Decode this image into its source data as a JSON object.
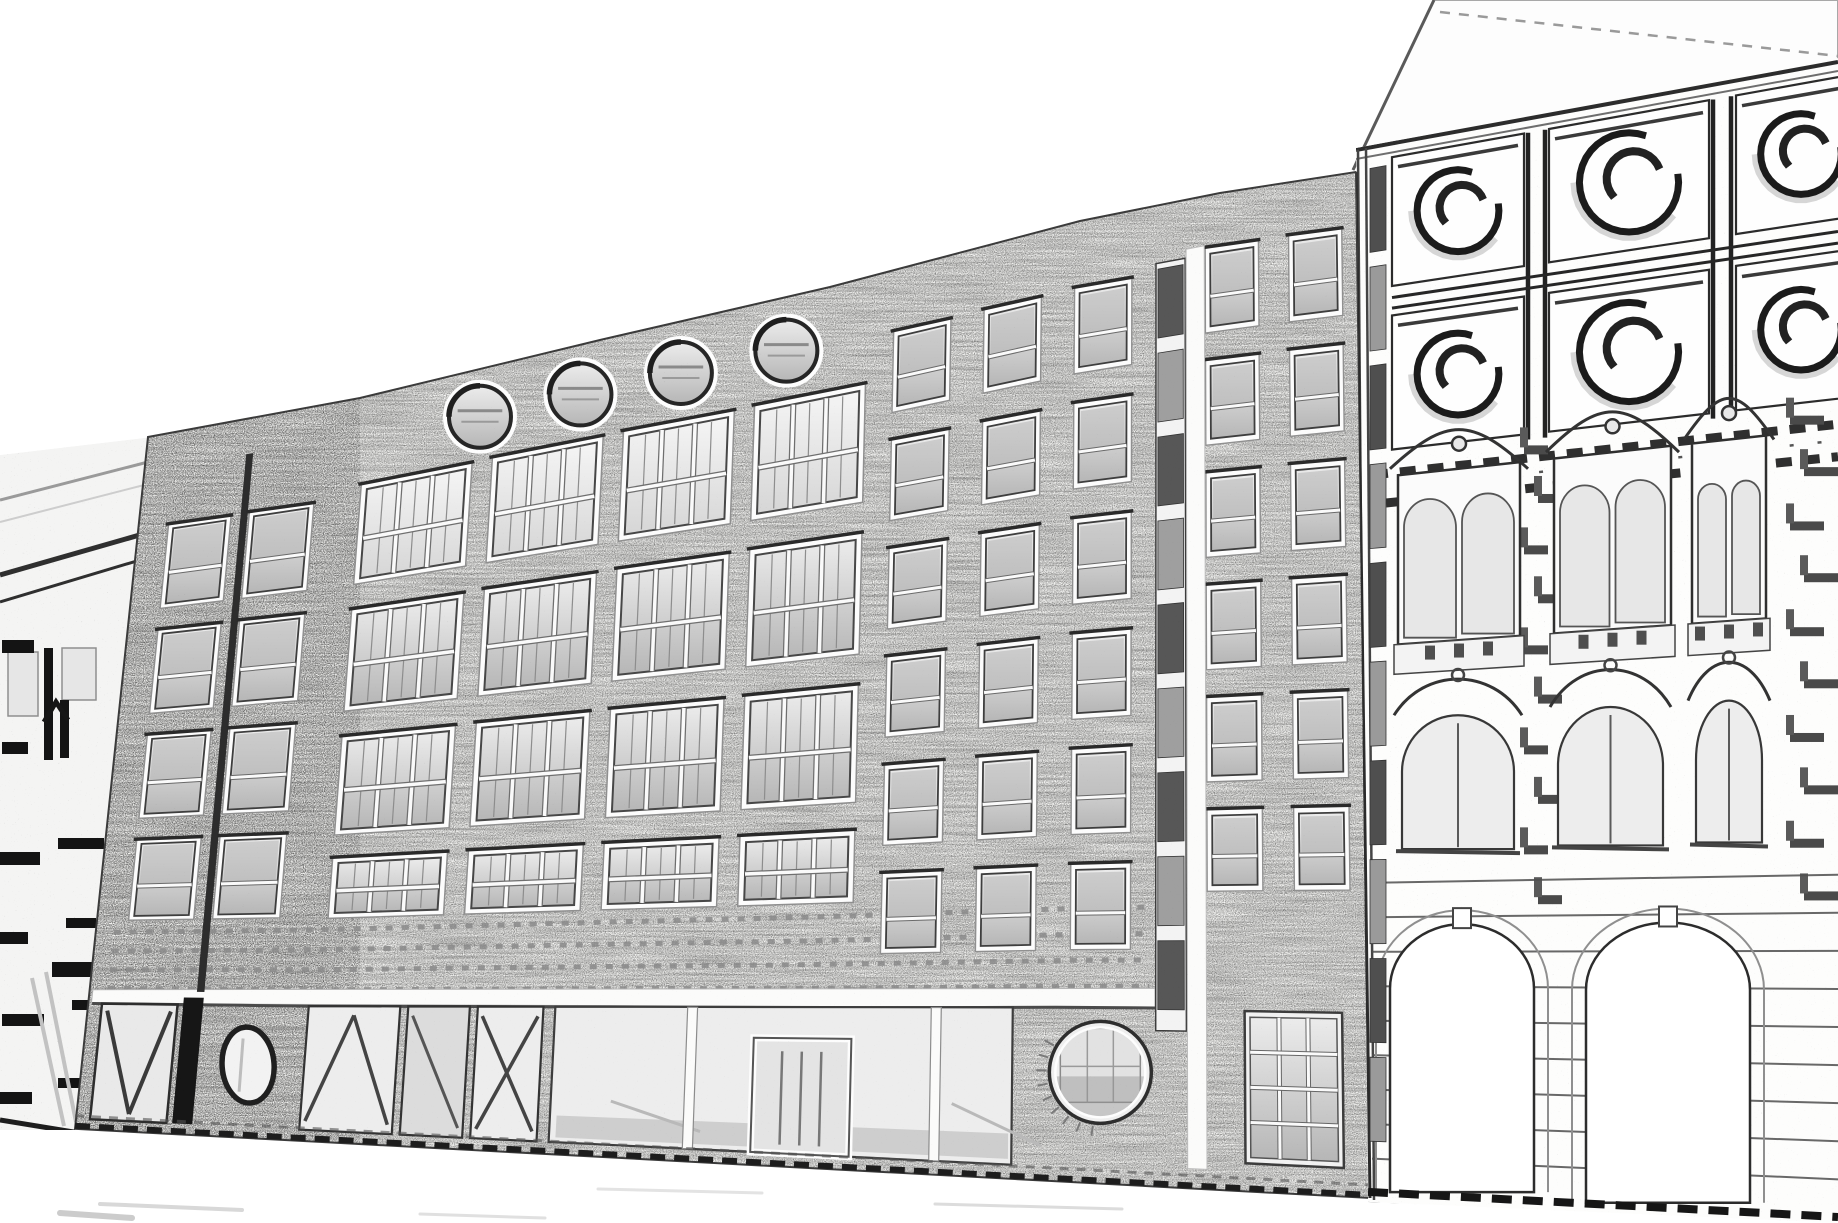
{
  "scene": {
    "kind": "pencil-sketch-street-facades",
    "canvas": {
      "w": 1838,
      "h": 1223,
      "sky": "#ffffff"
    },
    "colors": {
      "ink": "#1c1c1c",
      "line": "#3a3a3a",
      "mid": "#6e6e6e",
      "faint": "#c9c9c9",
      "wall": "#f6f6f4",
      "ornate_wall": "#fdfdfc",
      "frame": "#fcfcfc",
      "glass_dark": "#b9b9b9",
      "black": "#141414"
    },
    "brick_building": {
      "top_pts": [
        [
          148,
          437
        ],
        [
          360,
          398
        ],
        [
          600,
          340
        ],
        [
          830,
          287
        ],
        [
          1080,
          221
        ],
        [
          1220,
          193
        ],
        [
          1356,
          172
        ]
      ],
      "base": [
        60,
        1128,
        1838,
        1223
      ],
      "left_x": 148,
      "right_x": 1356,
      "lean_left": -73,
      "lean_right": 14,
      "bands": [
        {
          "name": "left-wing",
          "style": "sash2",
          "cols": [
            [
              178,
              240
            ],
            [
              258,
              322
            ]
          ],
          "rows": [
            [
              0.132,
              0.252
            ],
            [
              0.282,
              0.402
            ],
            [
              0.432,
              0.552
            ],
            [
              0.582,
              0.698
            ]
          ]
        },
        {
          "name": "main",
          "style": "industrial",
          "cols": [
            [
              368,
              478
            ],
            [
              498,
              608
            ],
            [
              628,
              738
            ],
            [
              758,
              868
            ]
          ],
          "rows": [
            [
              0.118,
              0.252
            ],
            [
              0.285,
              0.422
            ],
            [
              0.455,
              0.588
            ],
            [
              0.618,
              0.7
            ]
          ]
        },
        {
          "name": "attic-right",
          "style": "sash2",
          "cols": [
            [
              895,
              952
            ],
            [
              985,
              1042
            ],
            [
              1075,
              1132
            ]
          ],
          "rows": [
            [
              0.068,
              0.158
            ],
            [
              0.188,
              0.278
            ],
            [
              0.308,
              0.398
            ],
            [
              0.428,
              0.518
            ],
            [
              0.548,
              0.638
            ],
            [
              0.668,
              0.758
            ]
          ]
        },
        {
          "name": "right-wing",
          "style": "sash2",
          "cols": [
            [
              1205,
              1258
            ],
            [
              1288,
              1341
            ]
          ],
          "rows": [
            [
              0.052,
              0.138
            ],
            [
              0.165,
              0.251
            ],
            [
              0.278,
              0.364
            ],
            [
              0.391,
              0.477
            ],
            [
              0.504,
              0.59
            ],
            [
              0.617,
              0.7
            ]
          ]
        }
      ],
      "portholes": {
        "x": [
          483,
          583,
          683,
          788
        ],
        "f": 0.062,
        "r": 31
      },
      "stairwell": {
        "x": [
          1158,
          1183
        ],
        "f": [
          0.065,
          0.835
        ],
        "segs": 9
      },
      "pipe": {
        "x": 253,
        "f": [
          0.05,
          0.8
        ],
        "w": 7
      },
      "soldier": {
        "x": [
          165,
          1150
        ],
        "rows": [
          0.715,
          0.742,
          0.769,
          0.796
        ],
        "dash": "7 9"
      },
      "lintel": {
        "x": [
          92,
          1155
        ],
        "f": [
          0.798,
          0.818
        ]
      },
      "storefront": {
        "f": [
          0.818,
          0.985
        ],
        "vwin": [
          96,
          172
        ],
        "post": [
          178,
          198
        ],
        "oval_panel": [
          204,
          296
        ],
        "oval": {
          "cx": 248,
          "f": 0.9,
          "rx": 26,
          "ry": 38
        },
        "glassA": [
          304,
          396
        ],
        "glassB": [
          404,
          466
        ],
        "glassC": [
          474,
          540
        ],
        "wide": {
          "x": [
            552,
            1012
          ],
          "posts": [
            690,
            935
          ],
          "door": [
            752,
            850
          ],
          "transom": 0.952
        }
      },
      "circle_window": {
        "x": 1104,
        "f": 0.885,
        "r": 51
      },
      "grid_window": {
        "x": [
          1240,
          1332
        ],
        "f": [
          0.82,
          0.972
        ],
        "cols": 3,
        "rows": 4
      }
    },
    "ornate_building": {
      "cornice": [
        1356,
        150,
        1838,
        62
      ],
      "roof": {
        "pts": [
          [
            1353,
            170
          ],
          [
            1434,
            0
          ],
          [
            1838,
            0
          ],
          [
            1838,
            62
          ],
          [
            1360,
            152
          ]
        ],
        "ridge": [
          1440,
          12,
          1838,
          56
        ]
      },
      "edge_lines": [
        1358,
        1366
      ],
      "pipe_strip": {
        "x": [
          1370,
          1386
        ],
        "f": [
          0.02,
          0.96
        ],
        "segs": 10
      },
      "panels": {
        "cols": [
          [
            1392,
            1524
          ],
          [
            1549,
            1709
          ],
          [
            1736,
            1866
          ]
        ],
        "pilasters": [
          1528,
          1545,
          1713,
          1731
        ],
        "rows": [
          [
            0.013,
            0.135
          ],
          [
            0.163,
            0.29
          ]
        ],
        "rail": [
          0.146,
          0.156
        ],
        "circle_ratio": 0.31
      },
      "dentil": {
        "f": [
          0.312,
          0.34
        ],
        "dash": "16 12",
        "w": 9
      },
      "aedicules": {
        "x": [
          [
            1398,
            1520
          ],
          [
            1554,
            1671
          ],
          [
            1692,
            1766
          ]
        ],
        "ped": [
          0.272,
          0.315
        ],
        "body": [
          0.315,
          0.475
        ],
        "sill": [
          0.475,
          0.503
        ]
      },
      "arched": {
        "x": [
          [
            1402,
            1514
          ],
          [
            1558,
            1663
          ],
          [
            1696,
            1762
          ]
        ],
        "ped": [
          0.5,
          0.545
        ],
        "body": [
          0.545,
          0.67
        ],
        "sill": [
          0.67,
          0.695
        ]
      },
      "rust_blocks": {
        "cols": [
          [
            1790,
            34
          ],
          [
            1524,
            24
          ]
        ],
        "f": [
          0.3,
          0.72
        ],
        "step": 0.046
      },
      "rustication": {
        "x": [
          1372,
          1838
        ],
        "f": [
          0.7,
          0.985
        ],
        "step": 0.0328
      },
      "arches": [
        {
          "x": [
            1390,
            1534
          ]
        },
        {
          "x": [
            1586,
            1750
          ]
        }
      ],
      "arch_f": {
        "apex": 0.74,
        "spring": 0.8,
        "bottom": 0.99
      }
    },
    "left_building": {
      "clip": [
        [
          0,
          455
        ],
        [
          152,
          437
        ],
        [
          75,
          1130
        ],
        [
          0,
          1130
        ]
      ],
      "roof_lines": [
        [
          0,
          500,
          148,
          462
        ],
        [
          0,
          522,
          148,
          484
        ]
      ],
      "cornice": [
        [
          0,
          575,
          150,
          532,
          5
        ],
        [
          0,
          602,
          150,
          557,
          3
        ]
      ],
      "bars": [
        [
          2,
          640,
          32,
          13
        ],
        [
          44,
          648,
          9,
          112
        ],
        [
          2,
          742,
          26,
          12
        ],
        [
          60,
          700,
          9,
          58
        ],
        [
          0,
          852,
          40,
          13
        ],
        [
          58,
          838,
          46,
          11
        ],
        [
          0,
          932,
          28,
          12
        ],
        [
          66,
          918,
          30,
          10
        ],
        [
          2,
          1014,
          42,
          12
        ],
        [
          72,
          1000,
          20,
          10
        ],
        [
          0,
          1092,
          32,
          12
        ],
        [
          58,
          1078,
          34,
          10
        ],
        [
          52,
          962,
          74,
          15
        ]
      ],
      "light_rects": [
        [
          8,
          652,
          30,
          64
        ],
        [
          62,
          648,
          34,
          52
        ]
      ],
      "caret": [
        [
          44,
          722
        ],
        [
          56,
          702
        ],
        [
          68,
          720
        ]
      ],
      "diagonals": [
        [
          32,
          978,
          64,
          1126
        ],
        [
          46,
          972,
          76,
          1122
        ]
      ],
      "base_line": [
        0,
        1120,
        86,
        1134
      ]
    },
    "ground": {
      "faint_lines": [
        [
          100,
          1204,
          242,
          1210,
          "#d8d8d8",
          4
        ],
        [
          420,
          1214,
          545,
          1218,
          "#e0e0e0",
          3
        ],
        [
          598,
          1189,
          762,
          1193,
          "#e3e3e3",
          3
        ],
        [
          935,
          1204,
          1122,
          1209,
          "#dcdcdc",
          3
        ],
        [
          60,
          1213,
          132,
          1218,
          "#cccccc",
          6
        ]
      ]
    }
  }
}
